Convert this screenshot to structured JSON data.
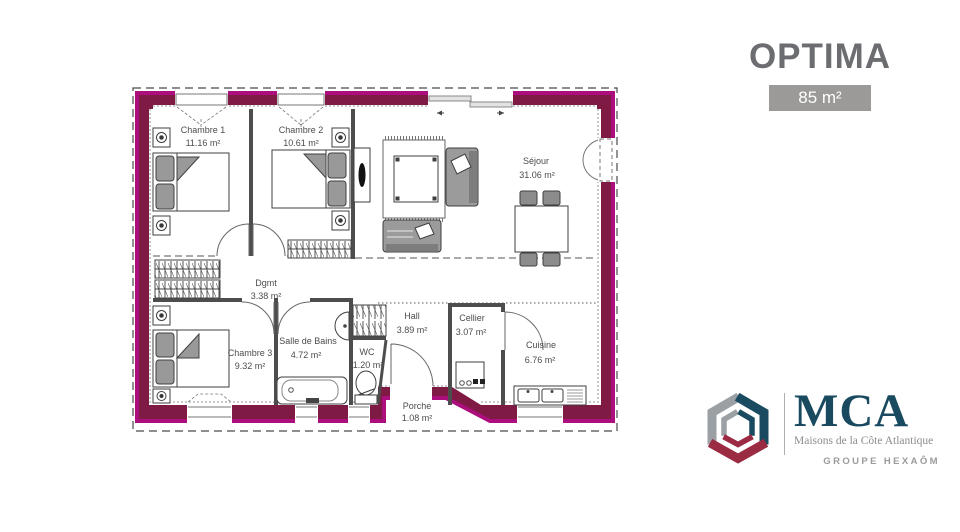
{
  "header": {
    "title": "OPTIMA",
    "area_badge": "85 m²"
  },
  "plan": {
    "rooms": [
      {
        "label": "Chambre 1",
        "area": "11.16 m²"
      },
      {
        "label": "Chambre 2",
        "area": "10.61 m²"
      },
      {
        "label": "Séjour",
        "area": "31.06 m²"
      },
      {
        "label": "Dgmt",
        "area": "3.38 m²"
      },
      {
        "label": "Chambre 3",
        "area": "9.32 m²"
      },
      {
        "label": "Salle de Bains",
        "area": "4.72 m²"
      },
      {
        "label": "WC",
        "area": "1.20 m²"
      },
      {
        "label": "Hall",
        "area": "3.89 m²"
      },
      {
        "label": "Cellier",
        "area": "3.07 m²"
      },
      {
        "label": "Cuisine",
        "area": "6.76 m²"
      },
      {
        "label": "Porche",
        "area": "1.08 m²"
      }
    ],
    "colors": {
      "wall_outline": "#ad0e7d",
      "wall_fill": "#7e1a44"
    }
  },
  "logo": {
    "acronym": "MCA",
    "tagline": "Maisons de la Côte Atlantique",
    "group": "GROUPE HEXAÔM",
    "colors": {
      "navy": "#1a4a5f",
      "red": "#9b2a43",
      "gray": "#9aa0a4"
    }
  }
}
